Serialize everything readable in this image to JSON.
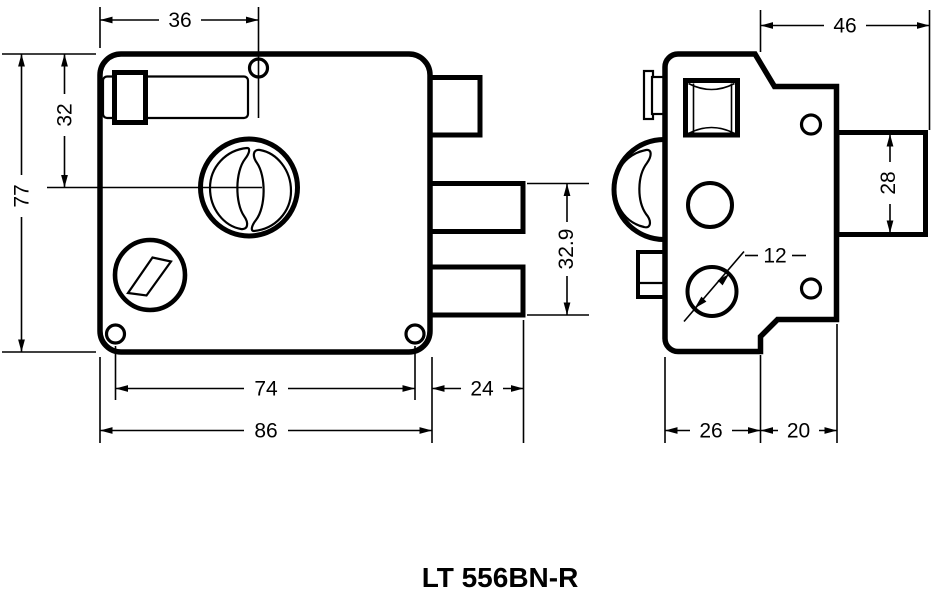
{
  "title": "LT 556BN-R",
  "colors": {
    "line": "#000000",
    "background": "#ffffff"
  },
  "front_view": {
    "dims": {
      "top_edge_width": "36",
      "top_to_cylinder": "32",
      "body_height": "77",
      "screw_spacing": "74",
      "body_width": "86",
      "bolt_throw": "24",
      "bolts_span": "32.9"
    }
  },
  "side_view": {
    "dims": {
      "total_depth": "46",
      "bolt_height": "28",
      "hole_diameter": "12",
      "front_depth": "26",
      "rear_depth": "20"
    }
  }
}
